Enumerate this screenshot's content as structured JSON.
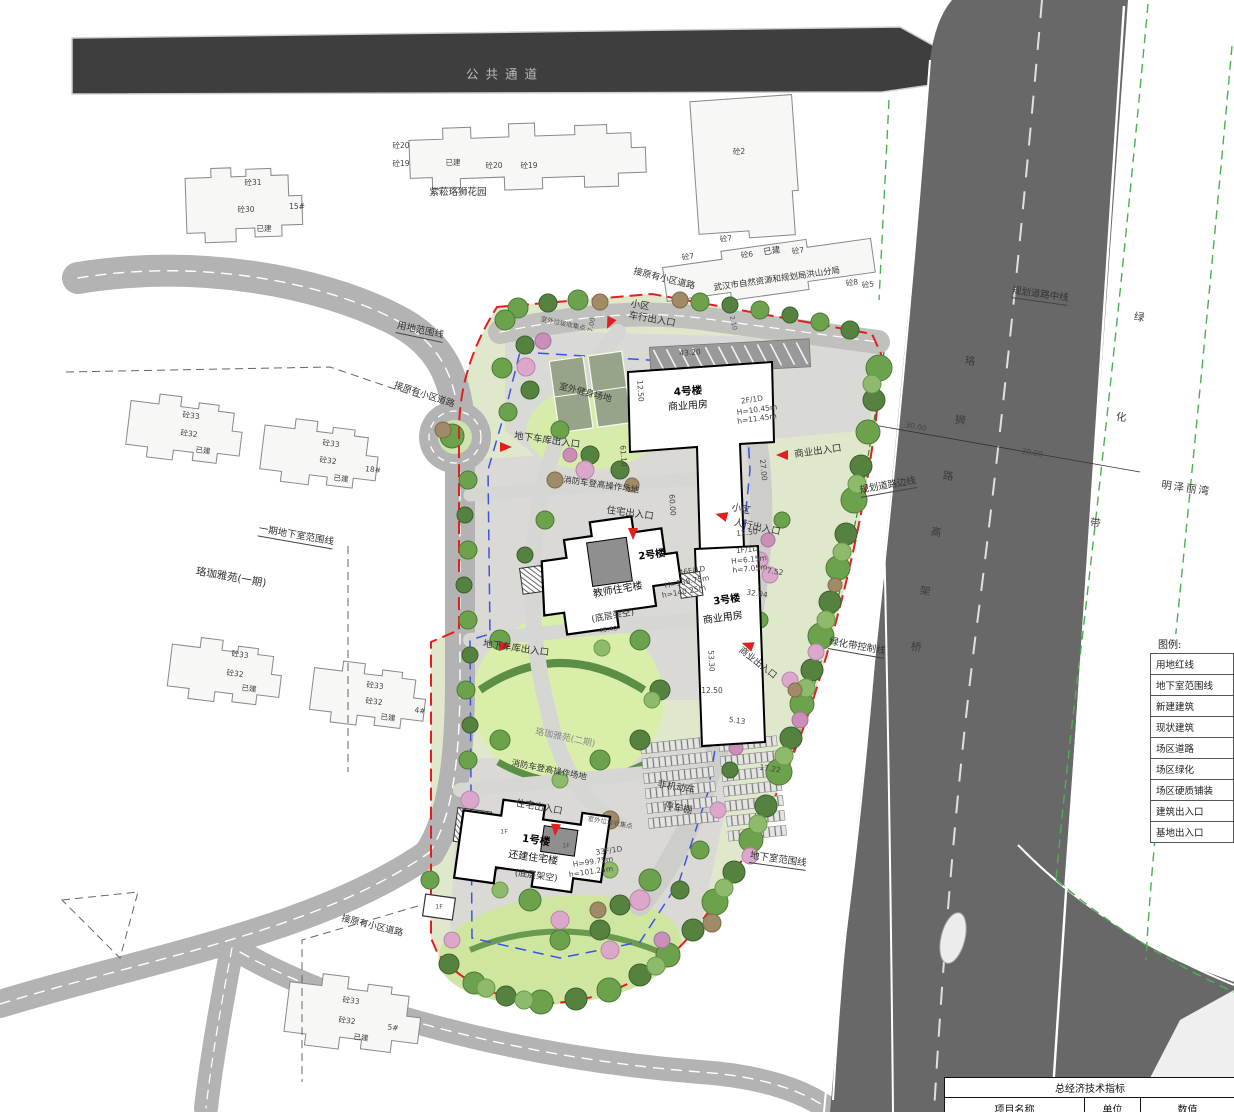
{
  "roads": {
    "public_passage": "公共通道",
    "connect_existing": "接原有小区道路",
    "plan_center": "规划道路中线",
    "plan_edge": "规划道路边线",
    "green_ctl": "绿化带控制线",
    "viaduct": [
      "珞",
      "狮",
      "路",
      "高",
      "架",
      "桥"
    ],
    "greenbelt": [
      "绿",
      "化",
      "带"
    ],
    "mingze": "明泽丽湾"
  },
  "site": {
    "boundary": "用地范围线",
    "ph1_underground": "一期地下室范围线",
    "underground": "地下室范围线",
    "luojia1": "珞珈雅苑(一期)",
    "luojia2": "珞珈雅苑(二期)",
    "zisong": "紫菘珞狮花园",
    "bureau": "武汉市自然资源和规划局洪山分局",
    "fitness": "室外健身场地",
    "fire_lane": "消防车登高操作场地",
    "trash": "室外垃圾收集点",
    "bike1": "非机动车",
    "bike2": "停车棚"
  },
  "ent": {
    "xiaoqu": "小区",
    "vehicle": "车行出入口",
    "ped": "人行出入口",
    "garage": "地下车库出入口",
    "biz": "商业出入口",
    "res": "住宅出入口"
  },
  "bld": {
    "b1": {
      "name": "1号楼",
      "type": "还建住宅楼",
      "note": "(底层架空)",
      "spec": "33F/1D",
      "H": "H=99.75m",
      "h": "h=101.25m"
    },
    "b2": {
      "name": "2号楼",
      "type": "教师住宅楼",
      "note": "(底层架空)",
      "spec": "46F/1D",
      "H": "H=138.75m",
      "h": "h=140.25m"
    },
    "b3": {
      "name": "3号楼",
      "type": "商业用房",
      "spec": "1F/1D",
      "H": "H=6.15m",
      "h": "h=7.05m"
    },
    "b4": {
      "name": "4号楼",
      "type": "商业用房",
      "spec": "2F/1D",
      "H": "H=10.45m",
      "h": "h=11.45m"
    },
    "f1": "1F"
  },
  "ex": {
    "e31": "砼31",
    "e30": "砼30",
    "e33": "砼33",
    "e32": "砼32",
    "e20": "砼20",
    "e19": "砼19",
    "e7": "砼7",
    "e6": "砼6",
    "e8": "砼8",
    "e5": "砼5",
    "e2": "砼2",
    "built": "已建",
    "n15": "15#",
    "n18": "18#",
    "n4": "4#",
    "n5": "5#"
  },
  "dims": {
    "d4320": "43.20",
    "d1250": "12.50",
    "d6110": "61.10",
    "d2700": "27.00",
    "d3000": "30.00",
    "d3204": "32.04",
    "d5330": "53.30",
    "d513": "5.13",
    "d1722": "17.22",
    "d752": "7.52",
    "d6000": "60.00",
    "d4540": "45.40",
    "d700": "7.00",
    "d210": "2.10"
  },
  "legend": {
    "title": "图例:",
    "items": [
      "用地红线",
      "地下室范围线",
      "新建建筑",
      "现状建筑",
      "场区道路",
      "场区绿化",
      "场区硬质铺装",
      "建筑出入口",
      "基地出入口"
    ]
  },
  "table": {
    "title": "总经济技术指标",
    "headers": [
      "项目名称",
      "单位",
      "数值"
    ]
  },
  "colors": {
    "red_line": "#e21f1f",
    "blue_line": "#3a55e0",
    "green_line": "#49b24f",
    "highway": "#686868",
    "road": "#b3b3b3",
    "dark_road": "#3e3e3e"
  }
}
